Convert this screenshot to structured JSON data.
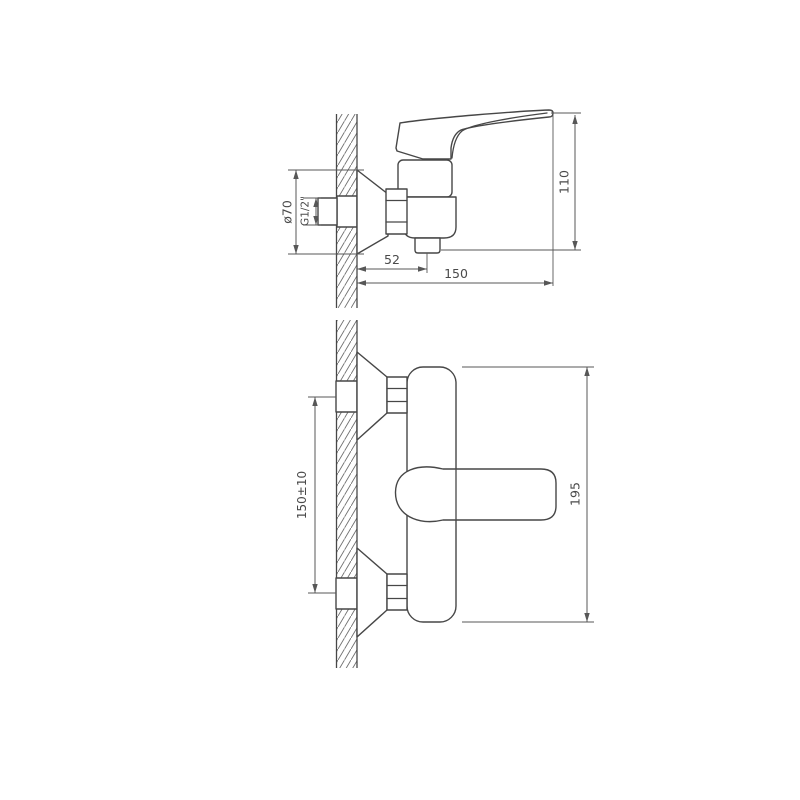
{
  "drawing": {
    "background": "#ffffff",
    "colors": {
      "outline": "#474747",
      "dimension": "#575757",
      "hatch": "#6f6f6f",
      "text": "#4a4a4a"
    },
    "side_view": {
      "dim_diameter": "ø70",
      "dim_thread": "G1/2\"",
      "dim_spout_offset": "52",
      "dim_depth": "150",
      "dim_height": "110"
    },
    "front_view": {
      "dim_connection_spacing": "150±10",
      "dim_body_height": "195"
    }
  }
}
